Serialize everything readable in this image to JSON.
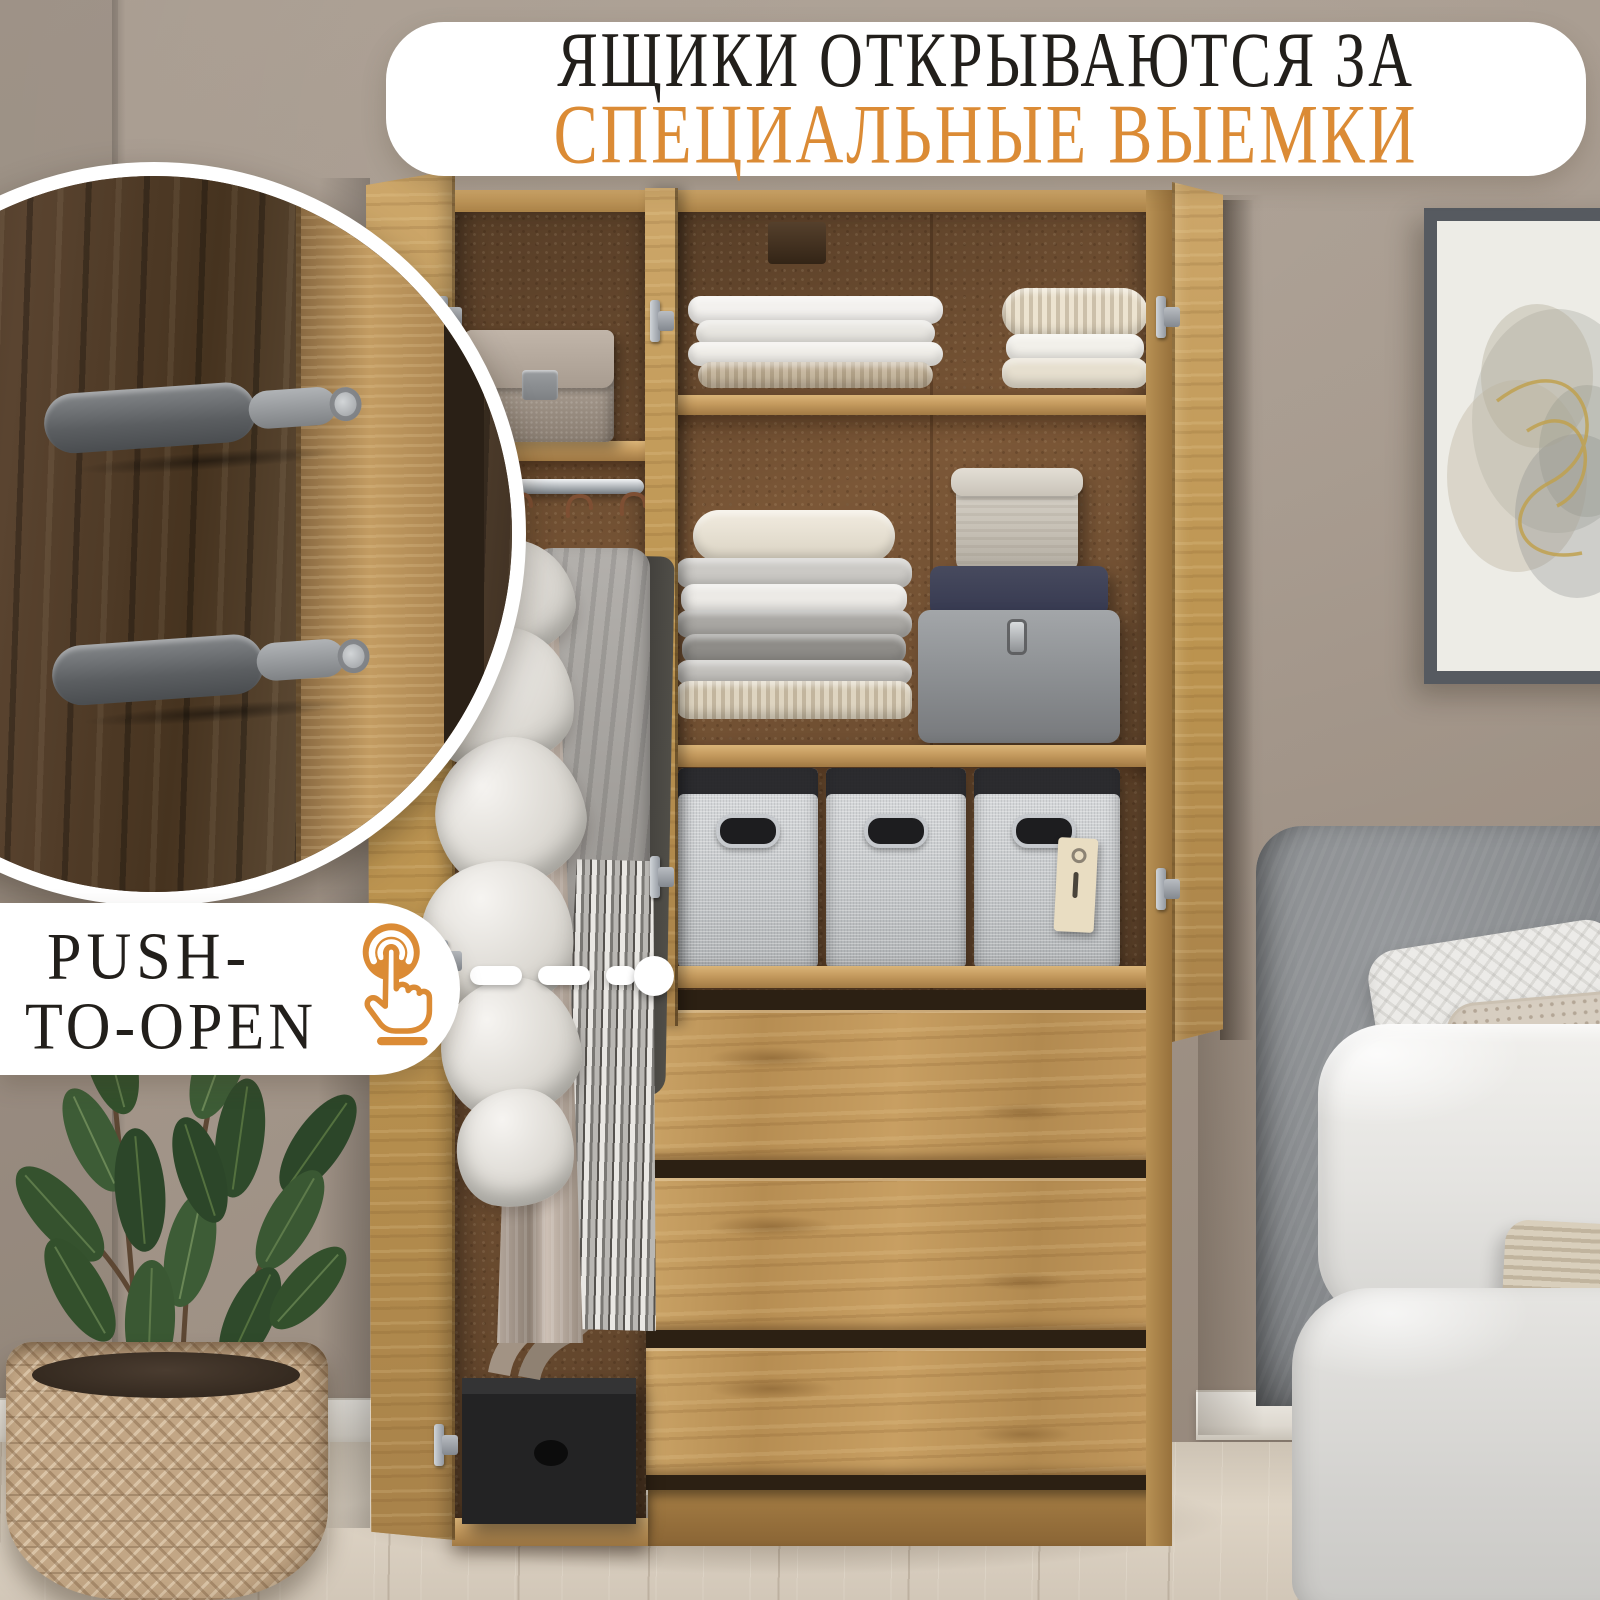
{
  "banner": {
    "line1": "ЯЩИКИ ОТКРЫВАЮТСЯ ЗА",
    "line2": "СПЕЦИАЛЬНЫЕ ВЫЕМКИ"
  },
  "push_callout": {
    "line1": "PUSH-",
    "line2": "TO-OPEN",
    "icon": "tap-finger-icon"
  },
  "colors": {
    "accent_orange": "#DB8B35",
    "headline_black": "#221F1B",
    "callout_bg": "#FFFFFF",
    "wall": "#A79A8E",
    "floor": "#D8CEC0",
    "oak": "#C49A5E",
    "oak_dark": "#A07A44",
    "cork_back": "#7B5737",
    "walnut_dark": "#4E3A2A",
    "metal_gray": "#9B9EA1",
    "basket_fabric": "#CFD2D4",
    "headboard_gray": "#888B8E",
    "bedding_white": "#ECEBE8",
    "leaf_green": "#3A5633",
    "pot_weave_tan": "#C2A685"
  }
}
